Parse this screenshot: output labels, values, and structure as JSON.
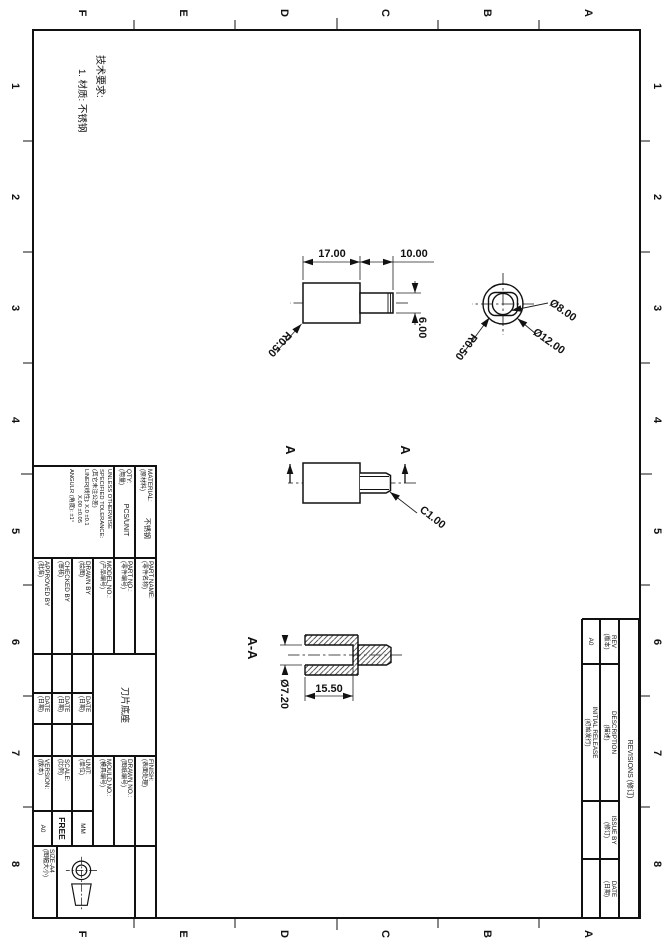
{
  "sheet": {
    "zone_letters": [
      "A",
      "B",
      "C",
      "D",
      "E",
      "F"
    ],
    "zone_numbers": [
      "1",
      "2",
      "3",
      "4",
      "5",
      "6",
      "7",
      "8"
    ]
  },
  "notes": {
    "heading": "技术要求:",
    "item1": "1. 材质: 不锈钢"
  },
  "views": {
    "front": {
      "len": "17.00",
      "shaft_len": "10.00",
      "shaft_dia": "6.00",
      "radius": "R0.50"
    },
    "end": {
      "bore": "Ø8.00",
      "outer": "Ø12.00",
      "radius": "R0.50"
    },
    "side": {
      "label_a": "A",
      "chamfer": "C1.00"
    },
    "section": {
      "title": "A-A",
      "bore_dia": "Ø7.20",
      "depth": "15.50"
    }
  },
  "title_block": {
    "material": {
      "en": "MATERIAL:",
      "cn": "(原材料)",
      "value": "不锈钢"
    },
    "qty": {
      "en": "QTY:",
      "cn": "(用量)",
      "value": "PCS/UNIT"
    },
    "tolerance": {
      "l1": "UNLESS OTHERWISE",
      "l2": "SPECIFIED TOLERANCE:",
      "l3": "(其它未注公差)",
      "l4": "LINER[线性]:  X.0  ±0.1",
      "l5": "X.00 ±0.05",
      "l6": "ANGULR (角度): ±1°"
    },
    "part_name": {
      "en": "PART NAME:",
      "cn": "(零件名称)",
      "value": "刀片底座"
    },
    "part_no": {
      "en": "PART NO.:",
      "cn": "(零件编号)"
    },
    "model_no": {
      "en": "MODEL NO.:",
      "cn": "(产品编号)"
    },
    "drawn_by": {
      "en": "DRAWN BY",
      "cn": "(绘图)"
    },
    "checked_by": {
      "en": "CHECKED BY",
      "cn": "(审核)"
    },
    "approved_by": {
      "en": "APPROVED BY",
      "cn": "(批准)"
    },
    "date": {
      "en": "DATE",
      "cn": "(日期)"
    },
    "finish": {
      "en": "FINISH:",
      "cn": "(表面处理)"
    },
    "drawn_no": {
      "en": "DRAWN NO.:",
      "cn": "(图纸编号)"
    },
    "mould_no": {
      "en": "MOULD NO.:",
      "cn": "(模具编号)"
    },
    "unit": {
      "en": "UNIT:",
      "cn": "(单位)",
      "value": "MM"
    },
    "scale": {
      "en": "SCALE:",
      "cn": "(比例)",
      "value": "FREE"
    },
    "version": {
      "en": "VERSION:",
      "cn": "(版本)",
      "value": "A0"
    },
    "size": {
      "en": "SIZE-A4",
      "cn": "(图幅大小)"
    }
  },
  "revisions": {
    "title": {
      "en": "REVISIONS",
      "cn": "(修订)"
    },
    "headers": {
      "rev": {
        "en": "REV",
        "cn": "(版本)"
      },
      "description": {
        "en": "DESCRIPTION",
        "cn": "(描述)"
      },
      "issue_by": {
        "en": "ISSUE BY",
        "cn": "(修订)"
      },
      "date": {
        "en": "DATE",
        "cn": "(日期)"
      }
    },
    "row": {
      "rev": "A0",
      "description_en": "INITIAL RELEASE",
      "description_cn": "(初始发行)",
      "issue_by": "",
      "date": ""
    }
  }
}
